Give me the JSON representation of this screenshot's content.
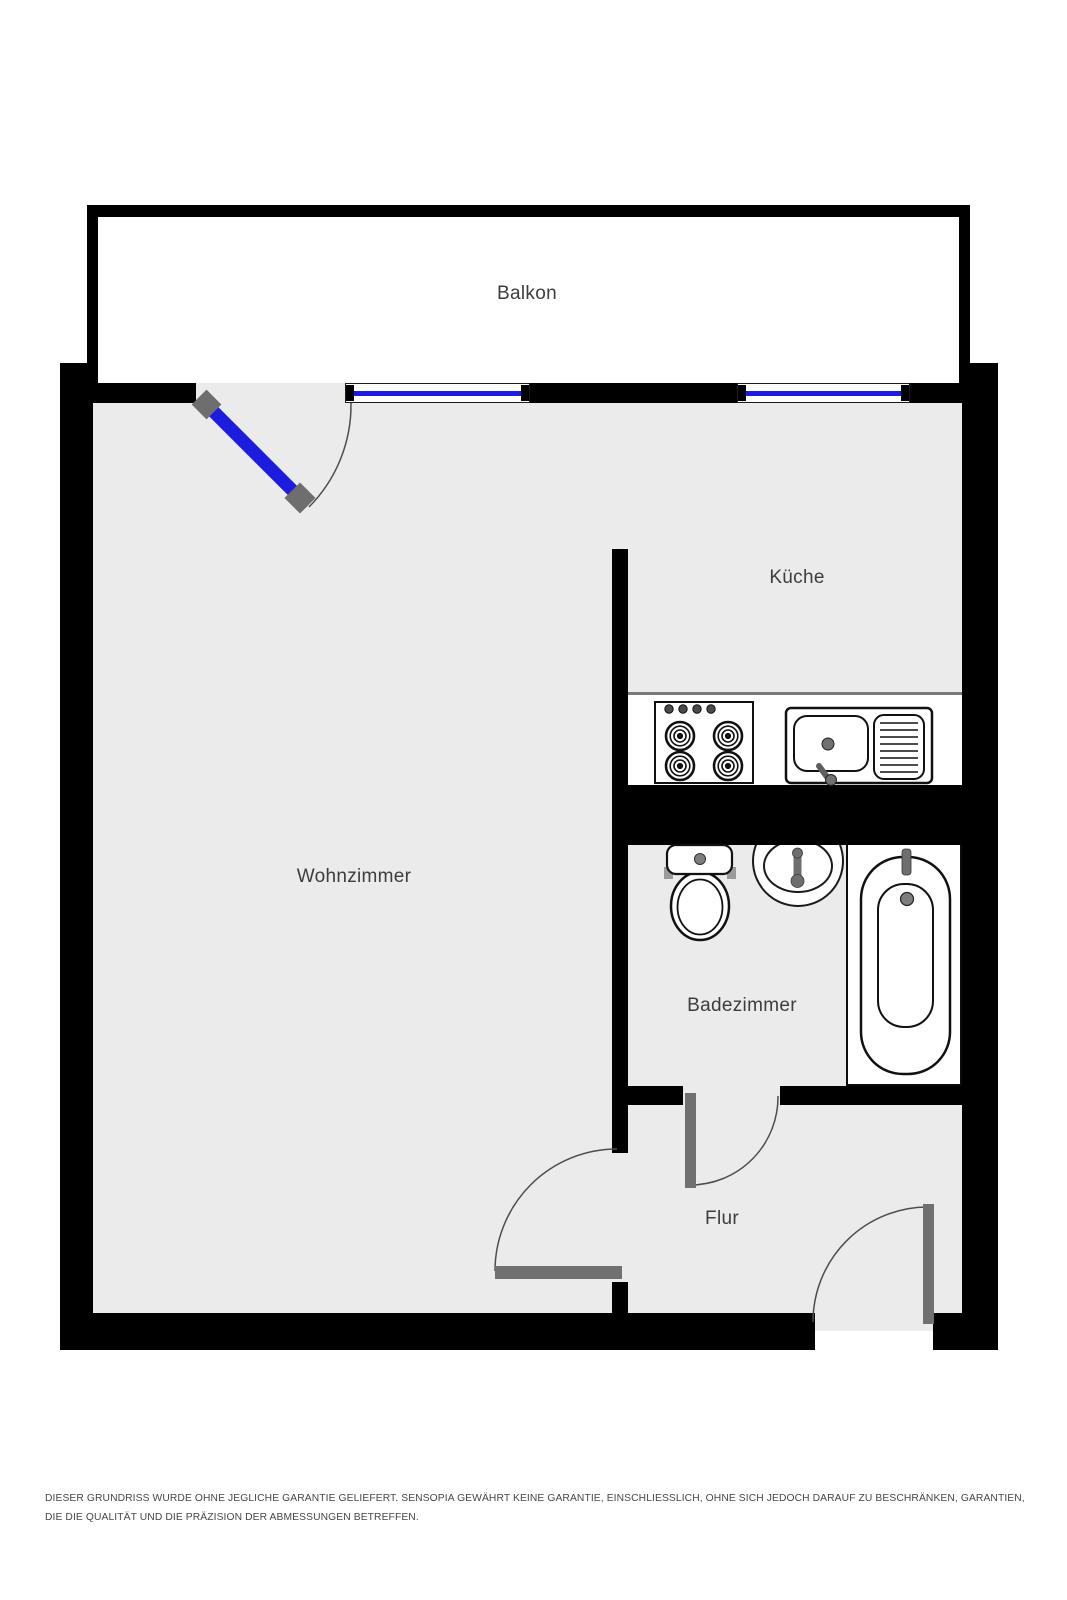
{
  "floorplan": {
    "rooms": [
      {
        "name": "balkon",
        "label": "Balkon"
      },
      {
        "name": "wohnzimmer",
        "label": "Wohnzimmer"
      },
      {
        "name": "kueche",
        "label": "Küche"
      },
      {
        "name": "badezimmer",
        "label": "Badezimmer"
      },
      {
        "name": "flur",
        "label": "Flur"
      }
    ],
    "fixtures": [
      "stove",
      "kitchen-sink",
      "toilet",
      "washbasin",
      "bathtub"
    ],
    "doors": [
      "balcony-door",
      "living-room-door",
      "bathroom-door",
      "entrance-door"
    ],
    "windows_count": 2,
    "colors": {
      "wall": "#000000",
      "floor": "#ebebeb",
      "door_leaf": "#707070",
      "balcony_door_blue": "#1c1ce0",
      "window_blue": "#1c1ce0",
      "label_text": "#3d3d3d"
    }
  },
  "footer": {
    "disclaimer": "DIESER GRUNDRISS WURDE OHNE JEGLICHE GARANTIE GELIEFERT. SENSOPIA GEWÄHRT KEINE GARANTIE, EINSCHLIESSLICH, OHNE SICH JEDOCH DARAUF ZU BESCHRÄNKEN, GARANTIEN, DIE DIE QUALITÄT UND DIE PRÄZISION DER ABMESSUNGEN BETREFFEN."
  }
}
